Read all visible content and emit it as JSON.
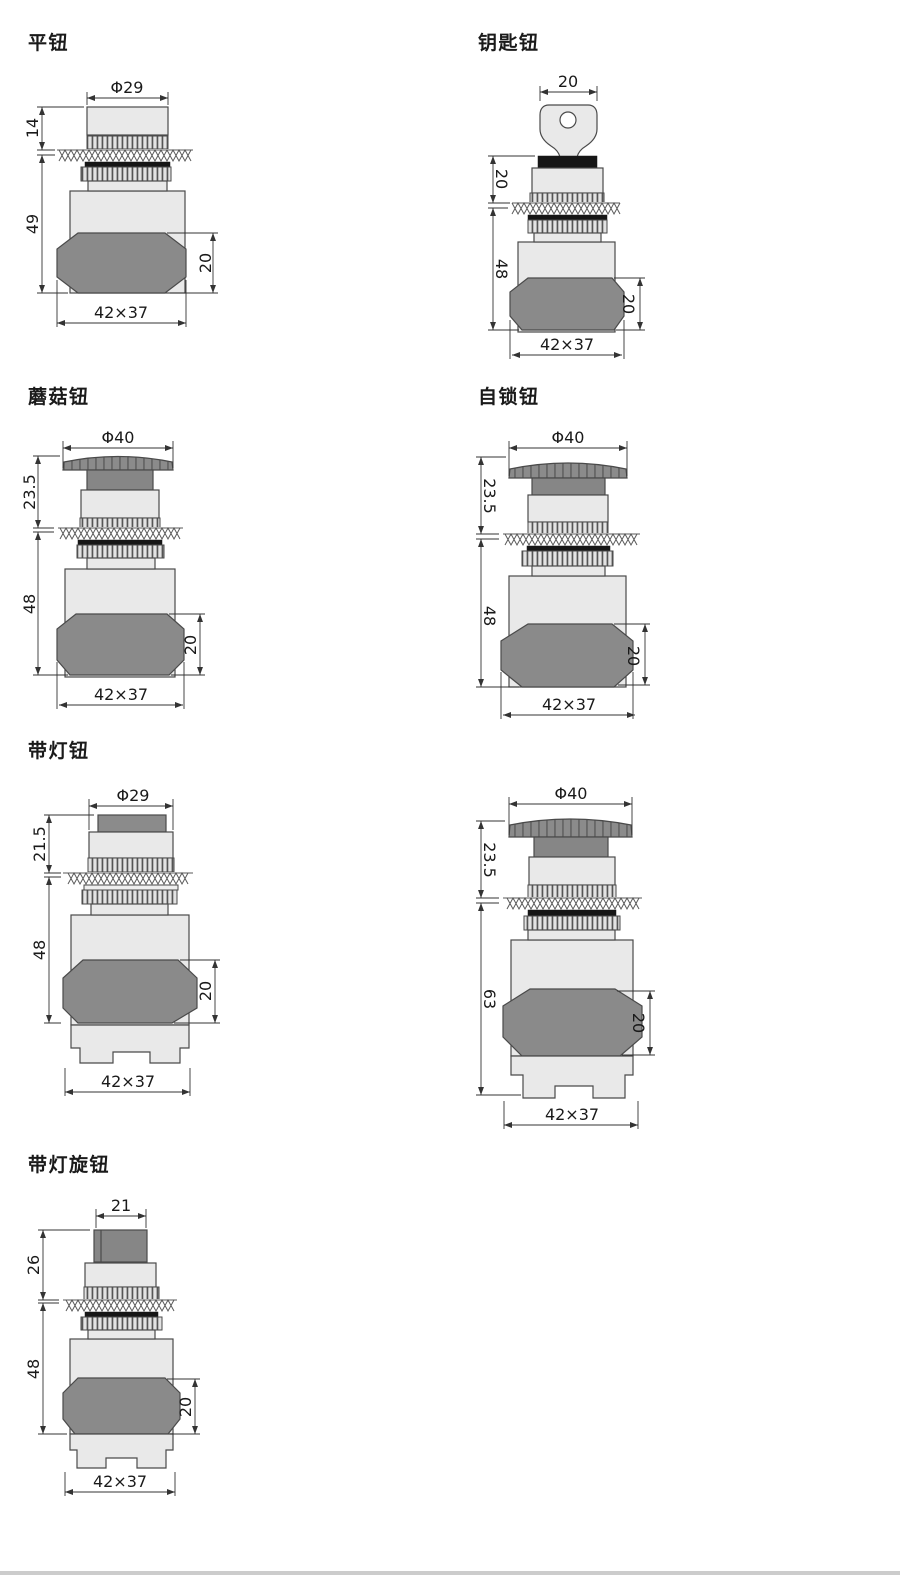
{
  "page": {
    "background": "#ffffff",
    "bottom_bar_color": "#cccccc"
  },
  "colors": {
    "light_fill": "#e9e9e9",
    "mid_gray": "#8b8b8b",
    "octagon_gray": "#8a8a8a",
    "seal_black": "#161616",
    "line": "#4a4a4a"
  },
  "figures": [
    {
      "id": "flat-button",
      "title": "平钮",
      "dims": {
        "top": "Φ29",
        "upper_left": "14",
        "left": "49",
        "right": "20",
        "bottom": "42×37"
      }
    },
    {
      "id": "key-button",
      "title": "钥匙钮",
      "dims": {
        "top": "20",
        "upper_left": "20",
        "left": "48",
        "right": "20",
        "bottom": "42×37"
      }
    },
    {
      "id": "mushroom-button",
      "title": "蘑菇钮",
      "dims": {
        "top": "Φ40",
        "upper_left": "23.5",
        "left": "48",
        "right": "20",
        "bottom": "42×37"
      }
    },
    {
      "id": "self-locking-button",
      "title": "自锁钮",
      "dims": {
        "top": "Φ40",
        "upper_left": "23.5",
        "left": "48",
        "right": "20",
        "bottom": "42×37"
      }
    },
    {
      "id": "illuminated-button",
      "title": "带灯钮",
      "dims": {
        "top": "Φ29",
        "upper_left": "21.5",
        "left": "48",
        "right": "20",
        "bottom": "42×37"
      }
    },
    {
      "id": "illuminated-mushroom-button",
      "title": null,
      "dims": {
        "top": "Φ40",
        "upper_left": "23.5",
        "left": "63",
        "right": "20",
        "bottom": "42×37"
      }
    },
    {
      "id": "illuminated-rotary-knob",
      "title": "带灯旋钮",
      "dims": {
        "top": "21",
        "upper_left": "26",
        "left": "48",
        "right": "20",
        "bottom": "42×37"
      }
    }
  ]
}
